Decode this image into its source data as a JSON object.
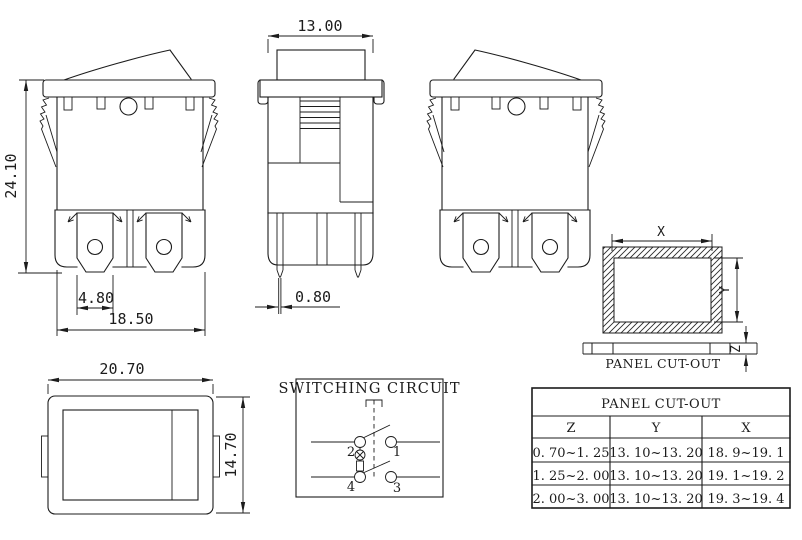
{
  "front_view": {
    "overall_height": "24.10",
    "terminal_width": "4.80",
    "body_width": "18.50"
  },
  "side_view": {
    "rocker_width": "13.00",
    "terminal_thickness": "0.80"
  },
  "top_view": {
    "width": "20.70",
    "height": "14.70"
  },
  "panel_cutout": {
    "x_label": "X",
    "y_label": "Y",
    "z_label": "Z",
    "caption": "PANEL CUT-OUT"
  },
  "switching_circuit": {
    "title": "SWITCHING CIRCUIT",
    "terminal_1": "1",
    "terminal_2": "2",
    "terminal_3": "3",
    "terminal_4": "4"
  },
  "table": {
    "title": "PANEL CUT-OUT",
    "columns": [
      "Z",
      "Y",
      "X"
    ],
    "rows": [
      [
        "0. 70~1. 25",
        "13. 10~13. 20",
        "18. 9~19. 1"
      ],
      [
        "1. 25~2. 00",
        "13. 10~13. 20",
        "19. 1~19. 2"
      ],
      [
        "2. 00~3. 00",
        "13. 10~13. 20",
        "19. 3~19. 4"
      ]
    ]
  }
}
